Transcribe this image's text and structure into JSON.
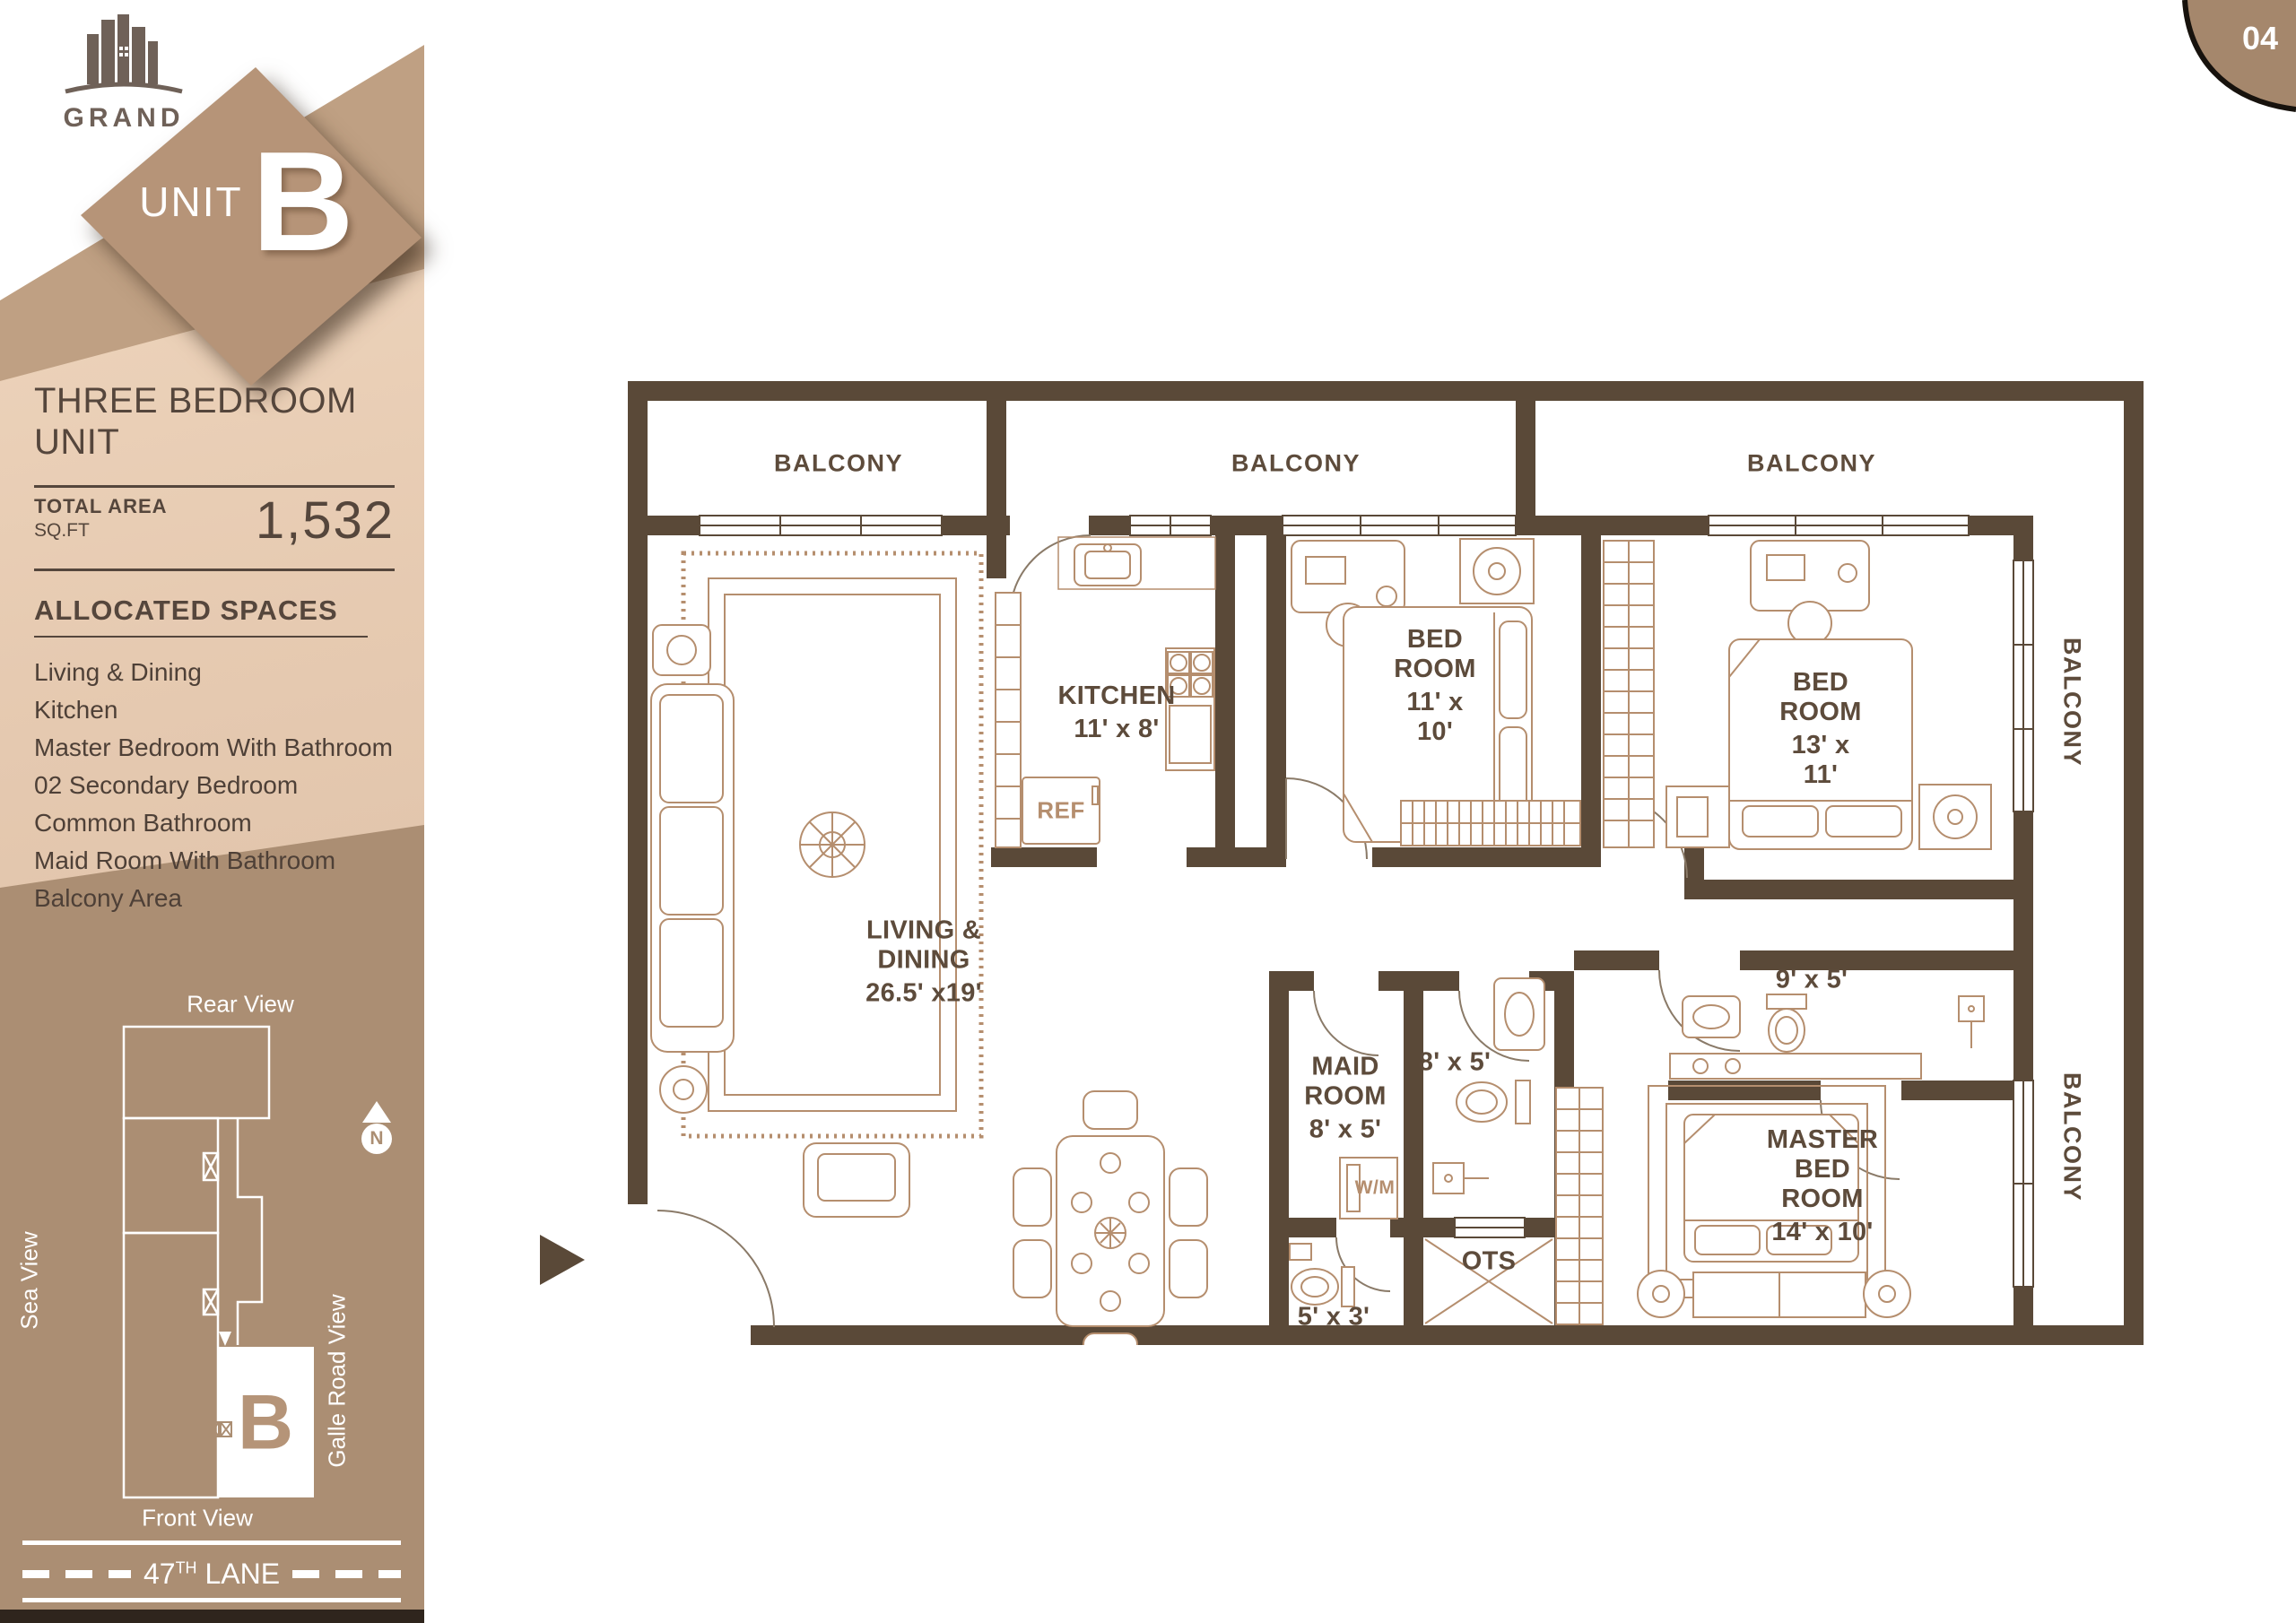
{
  "page_corner": {
    "number": "04"
  },
  "brand": {
    "name": "GRAND",
    "unit_word": "UNIT",
    "unit_letter": "B"
  },
  "unit_info": {
    "title": "THREE BEDROOM UNIT",
    "total_area_label": "TOTAL AREA",
    "area_unit": "SQ.FT",
    "area_value": "1,532",
    "allocated_title": "ALLOCATED SPACES",
    "allocated_spaces": [
      "Living & Dining",
      "Kitchen",
      "Master Bedroom With Bathroom",
      "02 Secondary Bedroom",
      "Common Bathroom",
      "Maid Room With Bathroom",
      "Balcony Area"
    ]
  },
  "site_map": {
    "rear_view_label": "Rear View",
    "front_view_label": "Front View",
    "sea_view_label": "Sea View",
    "galle_road_label": "Galle Road View",
    "compass_letter": "N",
    "unit_marker": "B",
    "lane_number": "47",
    "lane_suffix": "TH",
    "lane_word": "LANE"
  },
  "floor_plan": {
    "balcony_top_left": "BALCONY",
    "balcony_top_middle": "BALCONY",
    "balcony_top_right": "BALCONY",
    "balcony_side_upper": "BALCONY",
    "balcony_side_lower": "BALCONY",
    "living": {
      "name": "LIVING & DINING",
      "dims": "26.5' x19'"
    },
    "kitchen": {
      "name": "KITCHEN",
      "dims": "11' x 8'"
    },
    "bedroom_1": {
      "name": "BED ROOM",
      "dims": "11' x 10'"
    },
    "bedroom_2": {
      "name": "BED ROOM",
      "dims": "13' x 11'"
    },
    "master_bedroom": {
      "name": "MASTER BED ROOM",
      "dims": "14' x 10'"
    },
    "maid_room": {
      "name": "MAID ROOM",
      "dims": "8' x 5'"
    },
    "common_bathroom_dims": "8' x 5'",
    "master_bathroom_dims": "9' x 5'",
    "maid_bathroom_dims": "5' x 3'",
    "ots_label": "OTS",
    "fridge_label": "REF",
    "washer_label": "W/M"
  },
  "colors": {
    "wall": "#5a4938",
    "furniture_line": "#b58e6e",
    "label_text": "#5d4b3b",
    "sidebar_band": "#bfa083",
    "sidebar_map_bg": "#ab8e73",
    "accent_dark": "#55463c"
  }
}
